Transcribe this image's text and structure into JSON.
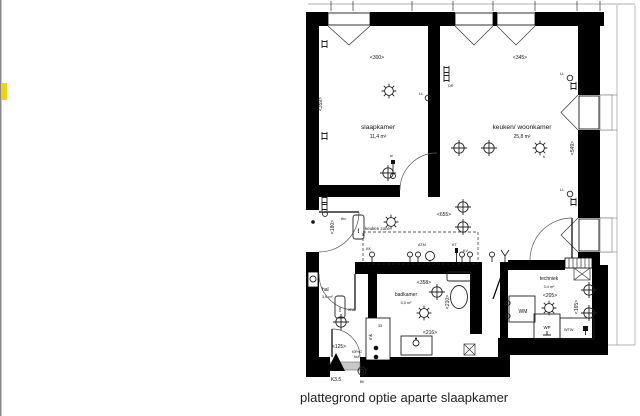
{
  "caption": "plattegrond optie aparte slaapkamer",
  "rooms": {
    "slaapkamer": {
      "name": "slaapkamer",
      "area": "11,4 m²"
    },
    "keuken": {
      "name": "keuken/ woonkamer",
      "area": "25,8 m²"
    },
    "hal": {
      "name": "hal",
      "area": "3,6 m²"
    },
    "badkamer": {
      "name": "badkamer",
      "area": "5,0 m²"
    },
    "techniek": {
      "name": "techniek",
      "area": "3,4 m²"
    }
  },
  "dimensions": {
    "slaapkamer_w": "<300>",
    "slaapkamer_h": "<359>",
    "keuken_w": "<345>",
    "keuken_h": "<549>",
    "keuken_inner": "<655>",
    "entry": "<180>",
    "hal_w": "<125>",
    "badkamer_w": "<358>",
    "badkamer_sink": "<216>",
    "wc": "<210>",
    "techniek_w": "<205>",
    "techniek_h": "<165>"
  },
  "zones": {
    "keuken_zone": "keuken zone"
  },
  "appliances": {
    "wm": "WM",
    "wp": "WP",
    "wtw": "WTW",
    "mk": "mk"
  },
  "labels": {
    "tbv": "tbv",
    "dr": "DR",
    "ll": "LL",
    "kk": "KK",
    "atm": "ATM",
    "kt": "KT",
    "kv": "KV",
    "tz": "tz",
    "rn": "2RN",
    "s33": "33",
    "meter1": "60PnG",
    "meter2": "6xA",
    "excl": "!",
    "b": "b"
  },
  "markers": {
    "k35": "K3.5",
    "bk": "BK"
  },
  "colors": {
    "wall": "#000000",
    "highlight": "#f2d500",
    "line": "#1a1a1a"
  }
}
